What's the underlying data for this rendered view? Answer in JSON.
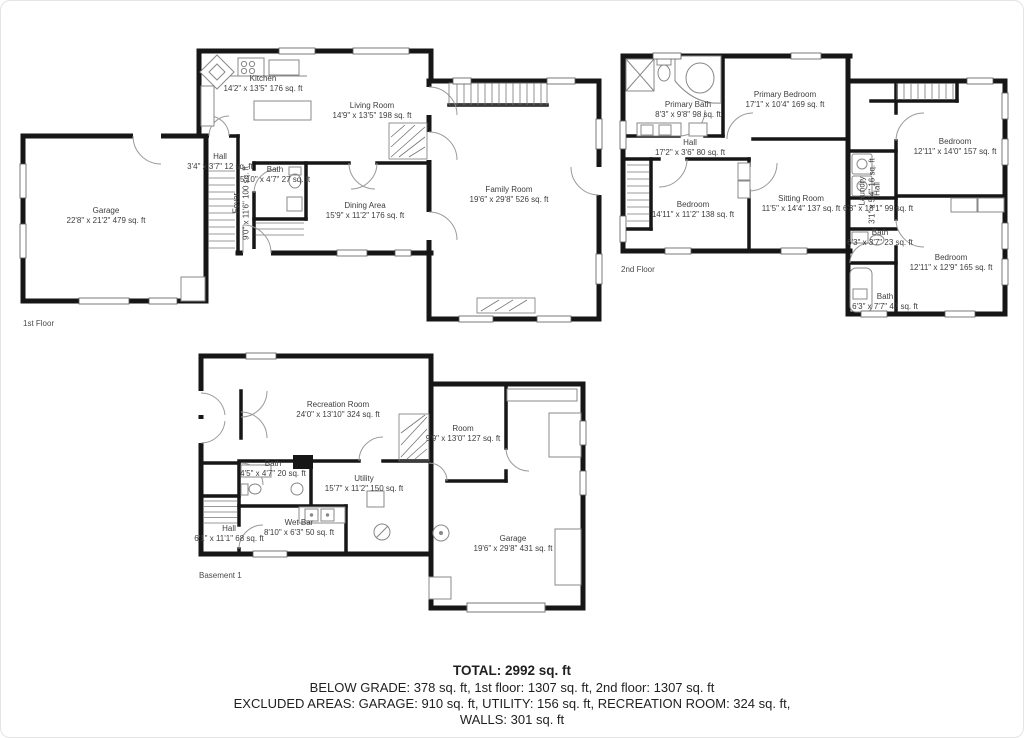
{
  "meta": {
    "wall_color": "#161616",
    "label_color": "#3d3d3d",
    "background": "#ffffff"
  },
  "floors": [
    {
      "name": "1st Floor",
      "rooms": [
        {
          "id": "kitchen",
          "label": "Kitchen",
          "dims": "14'2\" x 13'5\" 176 sq. ft"
        },
        {
          "id": "living-room",
          "label": "Living Room",
          "dims": "14'9\" x 13'5\" 198 sq. ft"
        },
        {
          "id": "garage",
          "label": "Garage",
          "dims": "22'8\" x 21'2\" 479 sq. ft"
        },
        {
          "id": "hall",
          "label": "Hall",
          "dims": "3'4\" x 3'7\" 12 sq. ft"
        },
        {
          "id": "foyer",
          "label": "Foyer",
          "dims": "9'0\" x 11'6\" 100 sq. ft"
        },
        {
          "id": "bath",
          "label": "Bath",
          "dims": "5'10\" x 4'7\" 27 sq. ft"
        },
        {
          "id": "dining-area",
          "label": "Dining Area",
          "dims": "15'9\" x 11'2\" 176 sq. ft"
        },
        {
          "id": "family-room",
          "label": "Family Room",
          "dims": "19'6\" x 29'8\" 526 sq. ft"
        }
      ]
    },
    {
      "name": "2nd Floor",
      "rooms": [
        {
          "id": "primary-bath",
          "label": "Primary Bath",
          "dims": "8'3\" x 9'8\" 98 sq. ft"
        },
        {
          "id": "primary-bedroom",
          "label": "Primary Bedroom",
          "dims": "17'1\" x 10'4\" 169 sq. ft"
        },
        {
          "id": "hall",
          "label": "Hall",
          "dims": "17'2\" x 3'6\" 80 sq. ft"
        },
        {
          "id": "bedroom-left",
          "label": "Bedroom",
          "dims": "14'11\" x 11'2\" 138 sq. ft"
        },
        {
          "id": "sitting-room",
          "label": "Sitting Room",
          "dims": "11'5\" x 14'4\" 137 sq. ft"
        },
        {
          "id": "laundry",
          "label": "Laundry",
          "dims": "3'1\" x 5'4\" 16 sq. ft"
        },
        {
          "id": "hall-2",
          "label": "Hall",
          "dims": "6'3\" x 18'1\" 99 sq. ft"
        },
        {
          "id": "bedroom-top-right",
          "label": "Bedroom",
          "dims": "12'11\" x 14'0\" 157 sq. ft"
        },
        {
          "id": "bath-middle",
          "label": "Bath",
          "dims": "6'3\" x 3'7\" 23 sq. ft"
        },
        {
          "id": "bedroom-bottom-right",
          "label": "Bedroom",
          "dims": "12'11\" x 12'9\" 165 sq. ft"
        },
        {
          "id": "bath-bottom",
          "label": "Bath",
          "dims": "6'3\" x 7'7\" 47 sq. ft"
        }
      ]
    },
    {
      "name": "Basement 1",
      "rooms": [
        {
          "id": "recreation-room",
          "label": "Recreation Room",
          "dims": "24'0\" x 13'10\" 324 sq. ft"
        },
        {
          "id": "room",
          "label": "Room",
          "dims": "9'9\" x 13'0\" 127 sq. ft"
        },
        {
          "id": "bath",
          "label": "Bath",
          "dims": "4'5\" x 4'7\" 20 sq. ft"
        },
        {
          "id": "utility",
          "label": "Utility",
          "dims": "15'7\" x 11'2\" 150 sq. ft"
        },
        {
          "id": "wet-bar",
          "label": "Wet Bar",
          "dims": "8'10\" x 6'3\" 50 sq. ft"
        },
        {
          "id": "hall",
          "label": "Hall",
          "dims": "6'1\" x 11'1\" 68 sq. ft"
        },
        {
          "id": "garage",
          "label": "Garage",
          "dims": "19'6\" x 29'8\" 431 sq. ft"
        }
      ]
    }
  ],
  "summary": {
    "total": "TOTAL: 2992 sq. ft",
    "grade_line": "BELOW GRADE: 378 sq. ft, 1st floor: 1307 sq. ft, 2nd floor: 1307 sq. ft",
    "excluded_line": "EXCLUDED AREAS: GARAGE: 910 sq. ft, UTILITY: 156 sq. ft, RECREATION ROOM: 324 sq. ft,",
    "walls_line": "WALLS: 301 sq. ft"
  }
}
